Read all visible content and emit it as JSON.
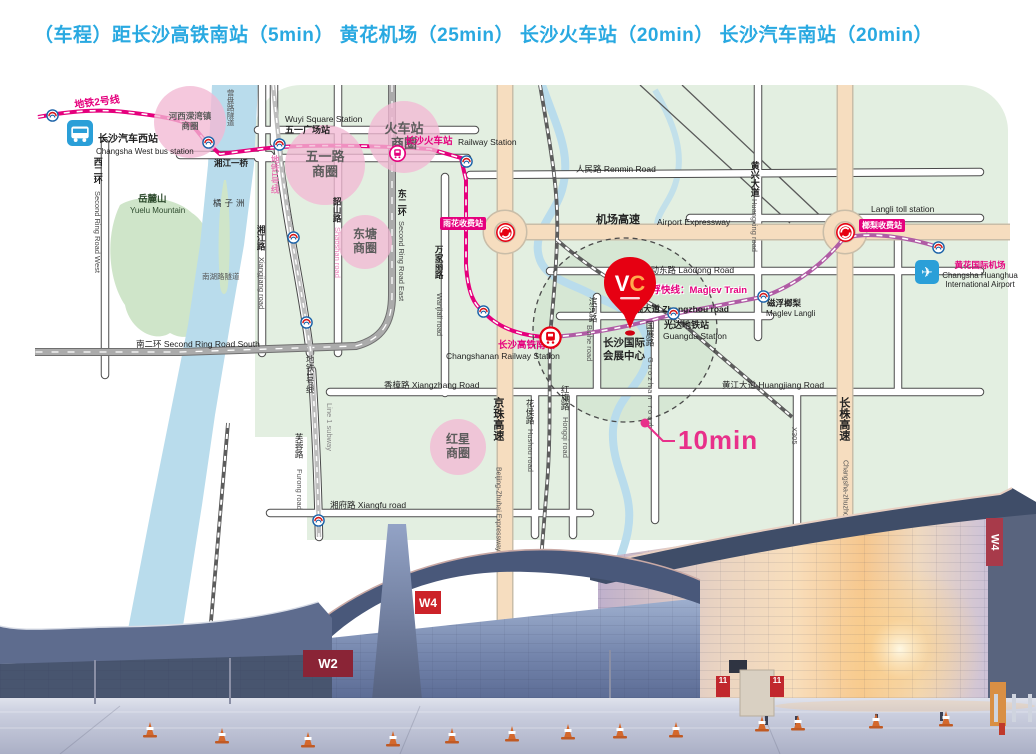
{
  "title": {
    "text": "（车程）距长沙高铁南站（5min）  黄花机场（25min）  长沙火车站（20min）  长沙汽车南站（20min）",
    "color": "#29a9e1"
  },
  "colors": {
    "title_blue": "#29a9e1",
    "metro_line2_pink": "#e5007d",
    "maglev_purple": "#b05ca5",
    "expressway_beige": "#f6ddbf",
    "map_green": "#e3efe1",
    "river_blue": "#b9dcec",
    "pin_red": "#e60012",
    "annotation_pink": "#e8308a",
    "business_circle_pink": "#f2b9d4"
  },
  "map": {
    "annotation": {
      "text": "10min"
    },
    "pin": {
      "monogram": "VC"
    },
    "business_circles": [
      {
        "lines": [
          "河西溁湾镇",
          "商圈"
        ],
        "x": 160,
        "y": 37,
        "r": 36,
        "fs": 8.5
      },
      {
        "lines": [
          "五一路",
          "商圈"
        ],
        "x": 295,
        "y": 80,
        "r": 40,
        "fs": 13
      },
      {
        "lines": [
          "火车站",
          "商圈"
        ],
        "x": 374,
        "y": 52,
        "r": 36,
        "fs": 13
      },
      {
        "lines": [
          "东塘",
          "商圈"
        ],
        "x": 335,
        "y": 157,
        "r": 27,
        "fs": 12
      },
      {
        "lines": [
          "红星",
          "商圈"
        ],
        "x": 428,
        "y": 362,
        "r": 28,
        "fs": 12
      }
    ],
    "chips": [
      {
        "t": "雨花收费站",
        "x": 410,
        "y": 132
      },
      {
        "t": "榔梨收费站",
        "x": 829,
        "y": 134
      }
    ],
    "labels": [
      {
        "t": "地铁2号线",
        "x": 44,
        "y": 16,
        "s": 10,
        "c": "#e5007d",
        "w": 700,
        "r": -7
      },
      {
        "t": "长沙汽车西站",
        "x": 68,
        "y": 50,
        "s": 10,
        "w": 700
      },
      {
        "t": "Changsha West bus station",
        "x": 66,
        "y": 63,
        "s": 8
      },
      {
        "t": "营盘路隧道",
        "x": 196,
        "y": 4,
        "s": 7.5,
        "c": "#555",
        "v": 1
      },
      {
        "t": "Wuyi Square Station",
        "x": 255,
        "y": 30,
        "s": 8.5
      },
      {
        "t": "五一广场站",
        "x": 255,
        "y": 41,
        "s": 9,
        "w": 700
      },
      {
        "t": "湘江一桥",
        "x": 184,
        "y": 74,
        "s": 8.5,
        "w": 700
      },
      {
        "t": "西二环",
        "x": 62,
        "y": 72,
        "s": 9,
        "w": 700,
        "v": 1
      },
      {
        "t": "Second Ring Road West",
        "x": 63,
        "y": 106,
        "s": 7.5,
        "c": "#444",
        "v": 1
      },
      {
        "t": "岳麓山",
        "x": 108,
        "y": 110,
        "s": 9.5,
        "w": 700,
        "c": "#2d4a2d"
      },
      {
        "t": "Yuelu Mountain",
        "x": 100,
        "y": 122,
        "s": 8,
        "c": "#2d4a2d"
      },
      {
        "t": "橘子洲",
        "x": 183,
        "y": 114,
        "s": 8.5,
        "c": "#333",
        "ls": 3
      },
      {
        "t": "南湖路隧道",
        "x": 172,
        "y": 188,
        "s": 7.5,
        "c": "#555"
      },
      {
        "t": "湘江路",
        "x": 226,
        "y": 140,
        "s": 8.5,
        "w": 700,
        "v": 1
      },
      {
        "t": "Xiangjiang road",
        "x": 227,
        "y": 172,
        "s": 7.5,
        "c": "#444",
        "v": 1
      },
      {
        "t": "韶山路",
        "x": 302,
        "y": 112,
        "s": 8.5,
        "w": 700,
        "v": 1
      },
      {
        "t": "Shaoshan road",
        "x": 303,
        "y": 142,
        "s": 7.5,
        "c": "#ee7fb8",
        "v": 1
      },
      {
        "t": "东二环",
        "x": 366,
        "y": 104,
        "s": 9,
        "w": 700,
        "v": 1
      },
      {
        "t": "Second Ring Road East",
        "x": 367,
        "y": 136,
        "s": 7.5,
        "c": "#444",
        "v": 1
      },
      {
        "t": "长沙火车站",
        "x": 375,
        "y": 52,
        "s": 9.5,
        "c": "#e5007d",
        "w": 700
      },
      {
        "t": "Railway Station",
        "x": 428,
        "y": 53,
        "s": 8.5
      },
      {
        "t": "人民路 Renmin Road",
        "x": 546,
        "y": 80,
        "s": 8.5
      },
      {
        "t": "万家丽路",
        "x": 404,
        "y": 160,
        "s": 8.5,
        "w": 700,
        "v": 1
      },
      {
        "t": "Wanjiali road",
        "x": 405,
        "y": 208,
        "s": 7.5,
        "c": "#444",
        "v": 1
      },
      {
        "t": "机场高速",
        "x": 566,
        "y": 130,
        "s": 11,
        "w": 700
      },
      {
        "t": "Airport Expressway",
        "x": 627,
        "y": 133,
        "s": 8.5
      },
      {
        "t": "Langli toll station",
        "x": 841,
        "y": 120,
        "s": 8.5
      },
      {
        "t": "劳动东路 Laodong Road",
        "x": 612,
        "y": 181,
        "s": 8.5
      },
      {
        "t": "黄兴大道",
        "x": 719,
        "y": 76,
        "s": 9,
        "w": 700,
        "v": 1
      },
      {
        "t": "Huangxing road",
        "x": 720,
        "y": 114,
        "s": 7.5,
        "c": "#555",
        "v": 1
      },
      {
        "t": "磁浮快线：Maglev Train",
        "x": 612,
        "y": 201,
        "s": 9.5,
        "c": "#e5007d",
        "w": 700,
        "h": 1
      },
      {
        "t": "磁浮榔梨",
        "x": 737,
        "y": 214,
        "s": 8.5,
        "w": 700
      },
      {
        "t": "Maglev Langli",
        "x": 736,
        "y": 225,
        "s": 8
      },
      {
        "t": "黄花国际机场",
        "x": 950,
        "y": 176,
        "s": 8.5,
        "c": "#e5007d",
        "w": 700,
        "a": 1
      },
      {
        "t": "Changsha Huanghua",
        "x": 950,
        "y": 187,
        "s": 8,
        "a": 1
      },
      {
        "t": "International Airport",
        "x": 950,
        "y": 196,
        "s": 8,
        "a": 1
      },
      {
        "t": "中轴大道 Zhongzhou road",
        "x": 596,
        "y": 220,
        "s": 8.5,
        "w": 700
      },
      {
        "t": "光达地铁站",
        "x": 634,
        "y": 236,
        "s": 9,
        "w": 700
      },
      {
        "t": "Guangda Station",
        "x": 633,
        "y": 247,
        "s": 8.5
      },
      {
        "t": "长沙国际",
        "x": 594,
        "y": 253,
        "s": 10.5,
        "w": 700,
        "a": 1
      },
      {
        "t": "会展中心",
        "x": 594,
        "y": 266,
        "s": 10.5,
        "w": 700,
        "a": 1
      },
      {
        "t": "长沙高铁南站",
        "x": 468,
        "y": 256,
        "s": 9.5,
        "c": "#e5007d",
        "w": 700
      },
      {
        "t": "Changshanan Railway Station",
        "x": 416,
        "y": 267,
        "s": 8.5
      },
      {
        "t": "黄江大道 Huangjiang Road",
        "x": 692,
        "y": 296,
        "s": 8.5
      },
      {
        "t": "香樟路 Xiangzhang Road",
        "x": 354,
        "y": 296,
        "s": 8.5
      },
      {
        "t": "京珠高速",
        "x": 461,
        "y": 312,
        "s": 11,
        "w": 700,
        "v": 1
      },
      {
        "t": "Beijing-Zhuhai Expressway",
        "x": 464,
        "y": 382,
        "s": 7,
        "c": "#555",
        "v": 1
      },
      {
        "t": "花侯路",
        "x": 495,
        "y": 314,
        "s": 8.5,
        "v": 1
      },
      {
        "t": "Hushou road",
        "x": 496,
        "y": 344,
        "s": 7.5,
        "c": "#555",
        "v": 1
      },
      {
        "t": "红旗路",
        "x": 530,
        "y": 300,
        "s": 8.5,
        "v": 1
      },
      {
        "t": "Hongqi road",
        "x": 531,
        "y": 332,
        "s": 7.5,
        "c": "#555",
        "v": 1
      },
      {
        "t": "国展路",
        "x": 615,
        "y": 236,
        "s": 8.5,
        "v": 1
      },
      {
        "t": "Guozhan road",
        "x": 616,
        "y": 272,
        "s": 7.5,
        "c": "#555",
        "v": 1,
        "ls": 2
      },
      {
        "t": "滨河路",
        "x": 558,
        "y": 212,
        "s": 8.5,
        "v": 1
      },
      {
        "t": "Binhe road",
        "x": 555,
        "y": 240,
        "s": 7.5,
        "c": "#555",
        "v": 1
      },
      {
        "t": "湘府路 Xiangfu road",
        "x": 300,
        "y": 416,
        "s": 8.5
      },
      {
        "t": "芙蓉路",
        "x": 264,
        "y": 348,
        "s": 8.5,
        "v": 1
      },
      {
        "t": "Furong road",
        "x": 265,
        "y": 384,
        "s": 7.5,
        "c": "#555",
        "v": 1
      },
      {
        "t": "南二环 Second Ring Road South",
        "x": 106,
        "y": 255,
        "s": 8.5
      },
      {
        "t": "地铁1号线",
        "x": 240,
        "y": 70,
        "s": 8.5,
        "c": "#e87ab5",
        "w": 700,
        "v": 1
      },
      {
        "t": "地铁1号线",
        "x": 275,
        "y": 270,
        "s": 8.5,
        "c": "#333",
        "v": 1
      },
      {
        "t": "Line 1 subway",
        "x": 295,
        "y": 318,
        "s": 7.5,
        "c": "#888",
        "v": 1
      },
      {
        "t": "X305",
        "x": 760,
        "y": 342,
        "s": 7.5,
        "c": "#555",
        "v": 1
      },
      {
        "t": "长株高速",
        "x": 807,
        "y": 312,
        "s": 11,
        "w": 700,
        "v": 1
      },
      {
        "t": "Changsha-zhuzhou Expressway",
        "x": 811,
        "y": 375,
        "s": 7,
        "c": "#555",
        "v": 1
      }
    ],
    "icons": [
      {
        "t": "bus",
        "x": 50,
        "y": 48
      },
      {
        "t": "plane",
        "x": 897,
        "y": 187
      },
      {
        "t": "train",
        "x": 367,
        "y": 68
      },
      {
        "t": "train-lg",
        "x": 520,
        "y": 252
      },
      {
        "t": "toll",
        "x": 475,
        "y": 147
      },
      {
        "t": "toll",
        "x": 815,
        "y": 147
      },
      {
        "t": "metro",
        "x": 22,
        "y": 30
      },
      {
        "t": "metro",
        "x": 178,
        "y": 57
      },
      {
        "t": "metro",
        "x": 249,
        "y": 59
      },
      {
        "t": "metro",
        "x": 436,
        "y": 76
      },
      {
        "t": "metro",
        "x": 263,
        "y": 152
      },
      {
        "t": "metro",
        "x": 276,
        "y": 237
      },
      {
        "t": "metro",
        "x": 288,
        "y": 435
      },
      {
        "t": "metro",
        "x": 453,
        "y": 226
      },
      {
        "t": "metro",
        "x": 643,
        "y": 228
      },
      {
        "t": "metro",
        "x": 733,
        "y": 211
      },
      {
        "t": "metro",
        "x": 908,
        "y": 162
      }
    ]
  },
  "photo": {
    "signs": {
      "w2": "W2",
      "w4_left": "W4",
      "w4_right": "W4",
      "gate1": "11",
      "gate2": "11"
    }
  }
}
